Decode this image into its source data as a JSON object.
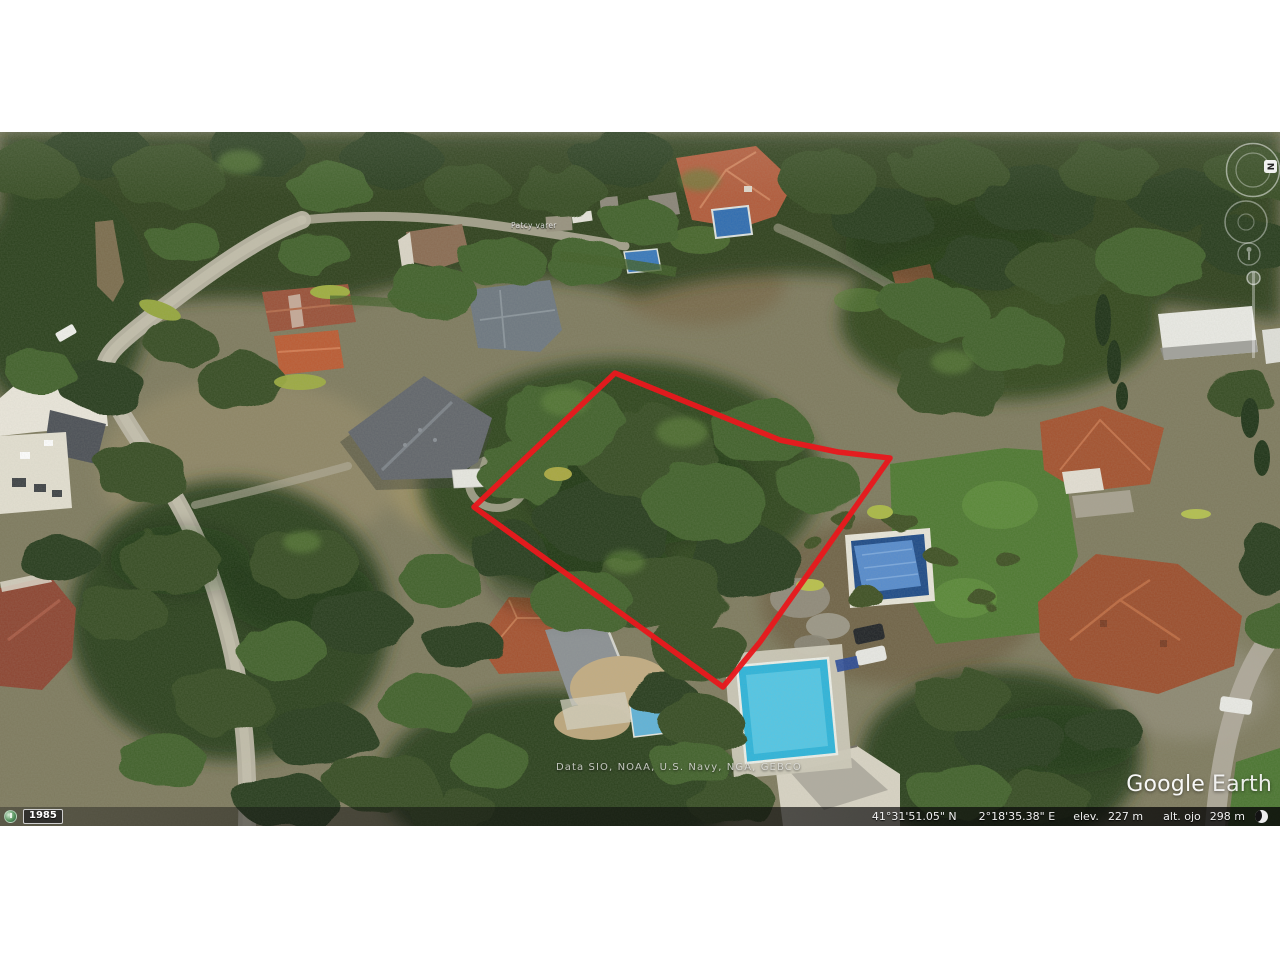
{
  "app": {
    "name": "Google Earth"
  },
  "map": {
    "place_label": "Patcy varer",
    "attribution": "Data SIO, NOAA, U.S. Navy, NGA, GEBCO",
    "watermark_google": "Google",
    "watermark_earth": "Earth"
  },
  "parcel": {
    "color": "#e8191d",
    "points": "615,373 780,440 838,452 890,458 818,560 760,642 723,687 474,507"
  },
  "history": {
    "year": "1985"
  },
  "nav": {
    "north_label": "N"
  },
  "statusbar": {
    "latitude": "41°31'51.05\" N",
    "longitude": "2°18'35.38\" E",
    "elev_label": "elev.",
    "elev_value": "227 m",
    "eye_label": "alt. ojo",
    "eye_value": "298 m"
  }
}
